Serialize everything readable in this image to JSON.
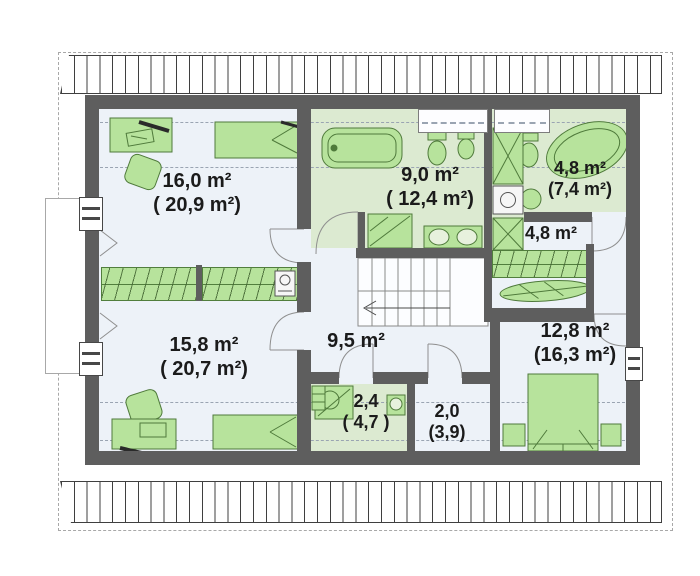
{
  "title": "attic-floor-plan",
  "units": "m²",
  "rooms": [
    {
      "name": "bedroom-top-left",
      "area": "16,0 m²",
      "total": "( 20,9 m²)"
    },
    {
      "name": "bathroom-main",
      "area": "9,0 m²",
      "total": "( 12,4 m²)"
    },
    {
      "name": "bathroom-ensuite",
      "area": "4,8 m²",
      "total": "(7,4 m²)"
    },
    {
      "name": "wardrobe-corridor",
      "area": "4,8 m²"
    },
    {
      "name": "bedroom-bottom-left",
      "area": "15,8 m²",
      "total": "( 20,7 m²)"
    },
    {
      "name": "hall",
      "area": "9,5 m²"
    },
    {
      "name": "shower-room",
      "area": "2,4",
      "total": "( 4,7 )"
    },
    {
      "name": "closet",
      "area": "2,0",
      "total": "(3,9)"
    },
    {
      "name": "bedroom-right",
      "area": "12,8 m²",
      "total": "(16,3 m²)"
    }
  ],
  "fixtures": [
    "bathtub",
    "corner-bathtub",
    "toilet",
    "bidet",
    "double-sink",
    "shower",
    "washing-machine",
    "wardrobe",
    "ironing-board",
    "staircase",
    "bed",
    "double-bed",
    "desk",
    "chair",
    "nightstand",
    "sink",
    "shelf"
  ],
  "colors": {
    "wall": "#5e5e5e",
    "floor": "#edf2f8",
    "bathroom_floor": "#dcead1",
    "furniture_fill": "#b7e39c",
    "furniture_stroke": "#4f7a3b",
    "roof_hatch": "#3f3f3f",
    "dashed_guides": "#9aa4b2",
    "label_text": "#1b1b1b"
  }
}
